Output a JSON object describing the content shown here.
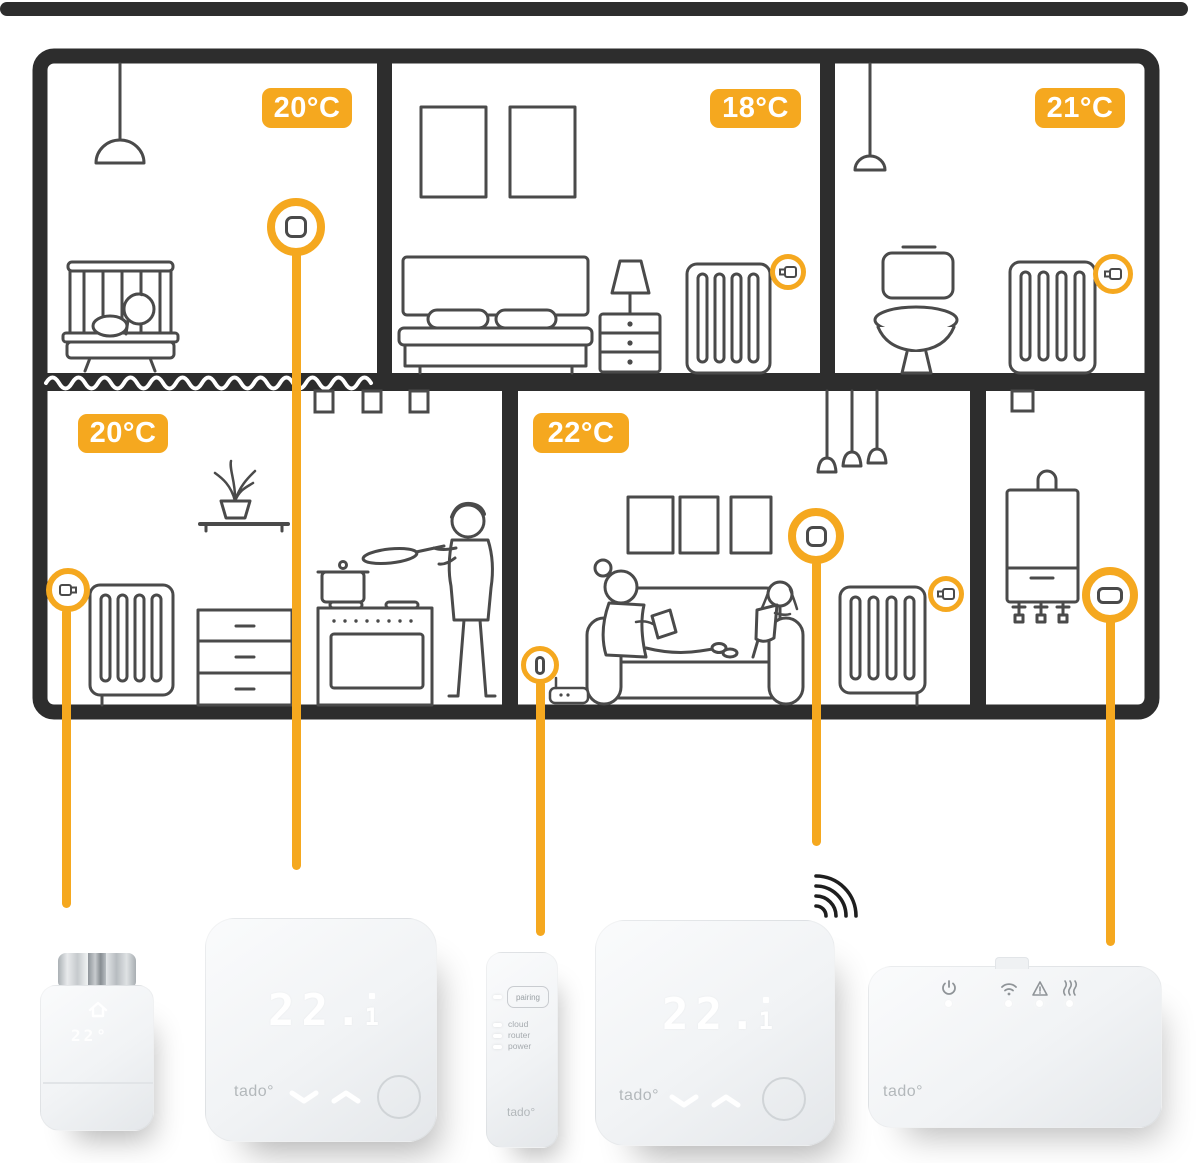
{
  "accent_color": "#F5A81F",
  "wall_color": "#2D2D2D",
  "rooms": [
    {
      "name": "nursery",
      "temperature": "20°C"
    },
    {
      "name": "bedroom",
      "temperature": "18°C"
    },
    {
      "name": "bathroom",
      "temperature": "21°C"
    },
    {
      "name": "kitchen",
      "temperature": "20°C"
    },
    {
      "name": "living-room",
      "temperature": "22°C"
    },
    {
      "name": "boiler-room",
      "temperature": ""
    }
  ],
  "products": {
    "radiator_thermostat": {
      "display": "22°"
    },
    "smart_thermostat_a": {
      "display_main": "22.",
      "display_sub": "1",
      "logo": "tado°"
    },
    "internet_bridge": {
      "pairing_label": "pairing",
      "led_labels": [
        "cloud",
        "router",
        "power"
      ],
      "logo": "tado°"
    },
    "smart_thermostat_b": {
      "display_main": "22.",
      "display_sub": "1",
      "logo": "tado°"
    },
    "wireless_receiver": {
      "logo": "tado°"
    }
  }
}
